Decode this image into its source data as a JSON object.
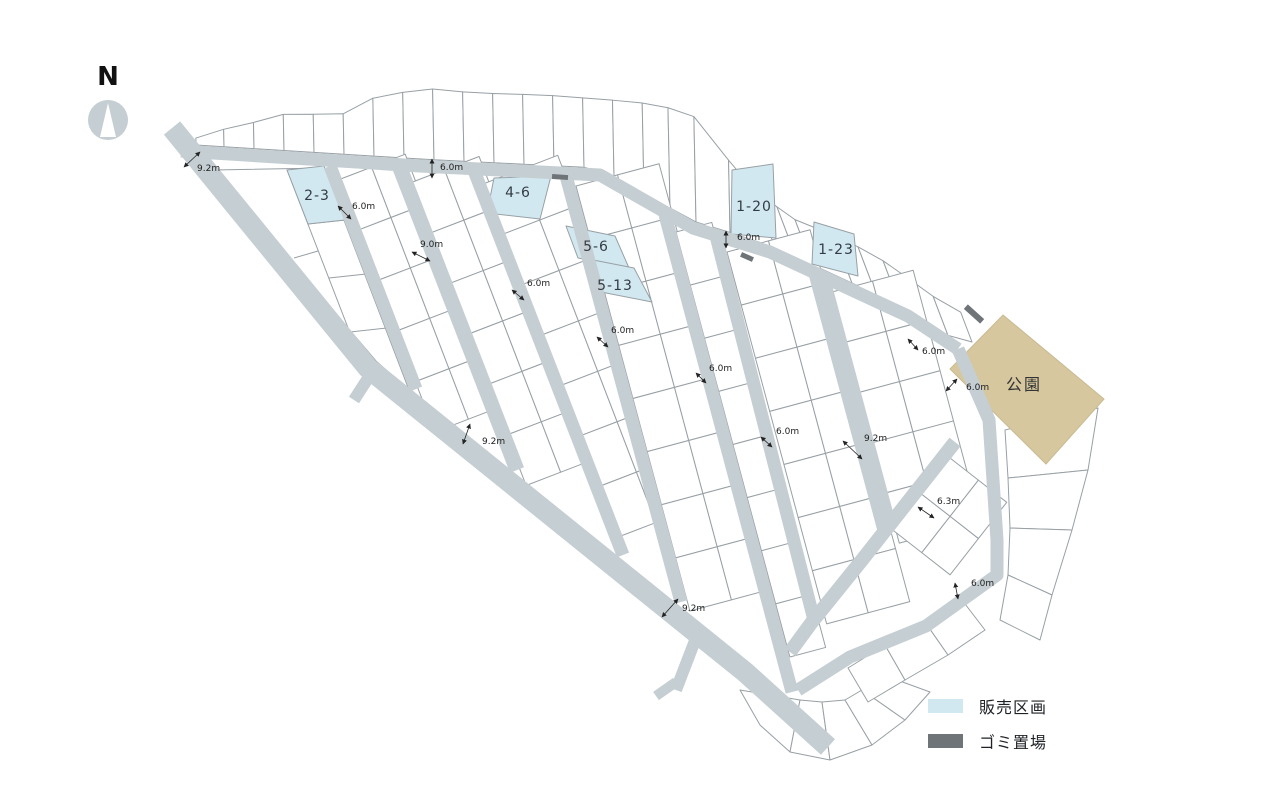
{
  "compass": {
    "label": "N"
  },
  "park": {
    "label": "公園"
  },
  "legend": {
    "sale_label": "販売区画",
    "garbage_label": "ゴミ置場"
  },
  "sale_lots": [
    {
      "id": "2-3"
    },
    {
      "id": "4-6"
    },
    {
      "id": "5-6"
    },
    {
      "id": "5-13"
    },
    {
      "id": "1-20"
    },
    {
      "id": "1-23"
    }
  ],
  "road_labels": [
    {
      "text": "9.2m"
    },
    {
      "text": "6.0m"
    },
    {
      "text": "6.0m"
    },
    {
      "text": "9.0m"
    },
    {
      "text": "6.0m"
    },
    {
      "text": "6.0m"
    },
    {
      "text": "6.0m"
    },
    {
      "text": "6.0m"
    },
    {
      "text": "6.0m"
    },
    {
      "text": "6.0m"
    },
    {
      "text": "9.2m"
    },
    {
      "text": "6.0m"
    },
    {
      "text": "9.2m"
    },
    {
      "text": "6.3m"
    },
    {
      "text": "6.0m"
    },
    {
      "text": "9.2m"
    }
  ],
  "colors": {
    "road": "#c5ced3",
    "lot_stroke": "#98a0a5",
    "sale": "#d2e8f1",
    "park": "#d6c79e",
    "garbage": "#6e7478",
    "label_text": "#333c44",
    "dim_text": "#222222"
  }
}
